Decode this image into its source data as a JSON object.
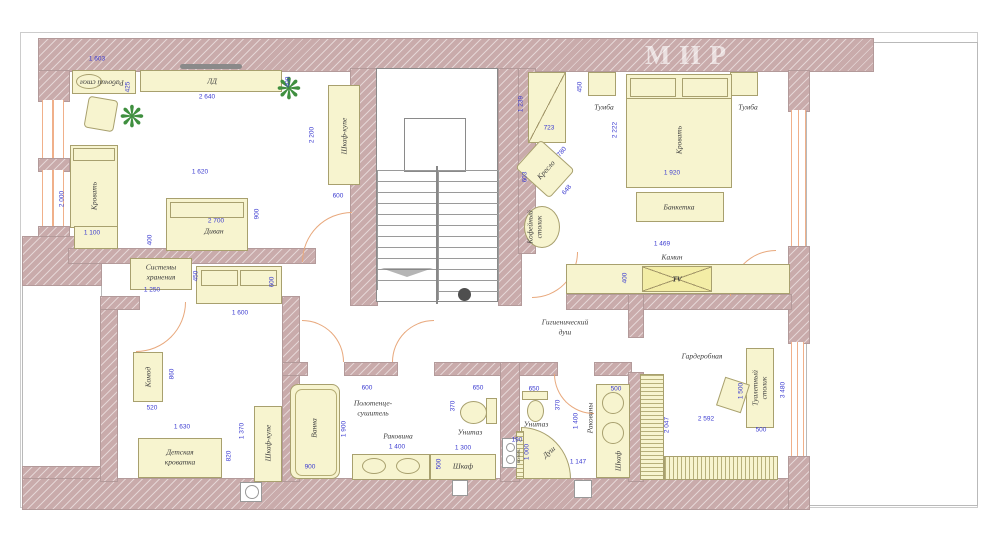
{
  "watermark": "МИР",
  "icons": {
    "plant": "❋"
  },
  "colors": {
    "wall": "#c9abab",
    "furniture": "#f7f4cf",
    "dimension": "#3b3bd0",
    "door": "#e8a87c",
    "window": "#f0b08a"
  },
  "labels": {
    "room1": {
      "desk": "Рабочий стол",
      "tv_unit": "ЛД",
      "wardrobe": "Шкаф-купе",
      "bed": "Кровать",
      "sofa": "Диван"
    },
    "kids": {
      "storage1": "Системы",
      "storage2": "хранения",
      "dresser": "Комод",
      "crib1": "Детская",
      "crib2": "кроватка",
      "wardrobe": "Шкаф-купе"
    },
    "bath": {
      "tub": "Ванна",
      "towel1": "Полотенце-",
      "towel2": "сушитель",
      "sink": "Раковина",
      "toilet": "Унитаз",
      "cabinet": "Шкаф"
    },
    "shower": {
      "toilet": "Унитаз",
      "stall": "Душ",
      "sinks": "Раковины",
      "cabinet": "Шкаф",
      "rail": "полот."
    },
    "hall": {
      "hyg1": "Гигиенический",
      "hyg2": "душ"
    },
    "master": {
      "nightstand_left": "Тумба",
      "nightstand_right": "Тумба",
      "bed": "Кровать",
      "bench": "Банкетка",
      "armchair": "Кресло",
      "coffee1": "Кофейный",
      "coffee2": "столик",
      "fireplace": "Камин",
      "tv": "TV"
    },
    "wardrobe_room": {
      "name": "Гардеробная",
      "vanity1": "Туалетный",
      "vanity2": "столик"
    }
  },
  "dims": {
    "d1": "1 603",
    "d2": "2 640",
    "d3": "400",
    "d4": "2 200",
    "d5": "600",
    "d6": "1 620",
    "d7": "2 700",
    "d8": "900",
    "d9": "400",
    "d10": "2 000",
    "d11": "1 100",
    "d12": "425",
    "d13": "450",
    "d14": "600",
    "d15": "1 250",
    "d16": "1 600",
    "d17": "860",
    "d18": "520",
    "d19": "1 630",
    "d20": "1 370",
    "d21": "820",
    "d22": "1 900",
    "d23": "600",
    "d24": "900",
    "d25": "1 400",
    "d26": "650",
    "d27": "370",
    "d28": "1 300",
    "d29": "500",
    "d30": "650",
    "d31": "370",
    "d32": "1 400",
    "d33": "190",
    "d34": "1 000",
    "d35": "1 147",
    "d36": "500",
    "d37": "1 239",
    "d38": "723",
    "d39": "450",
    "d40": "2 222",
    "d41": "1 920",
    "d42": "1 469",
    "d43": "780",
    "d44": "603",
    "d45": "648",
    "d46": "400",
    "d47": "2 592",
    "d48": "2 047",
    "d49": "1 500",
    "d50": "500",
    "d51": "3 480"
  }
}
